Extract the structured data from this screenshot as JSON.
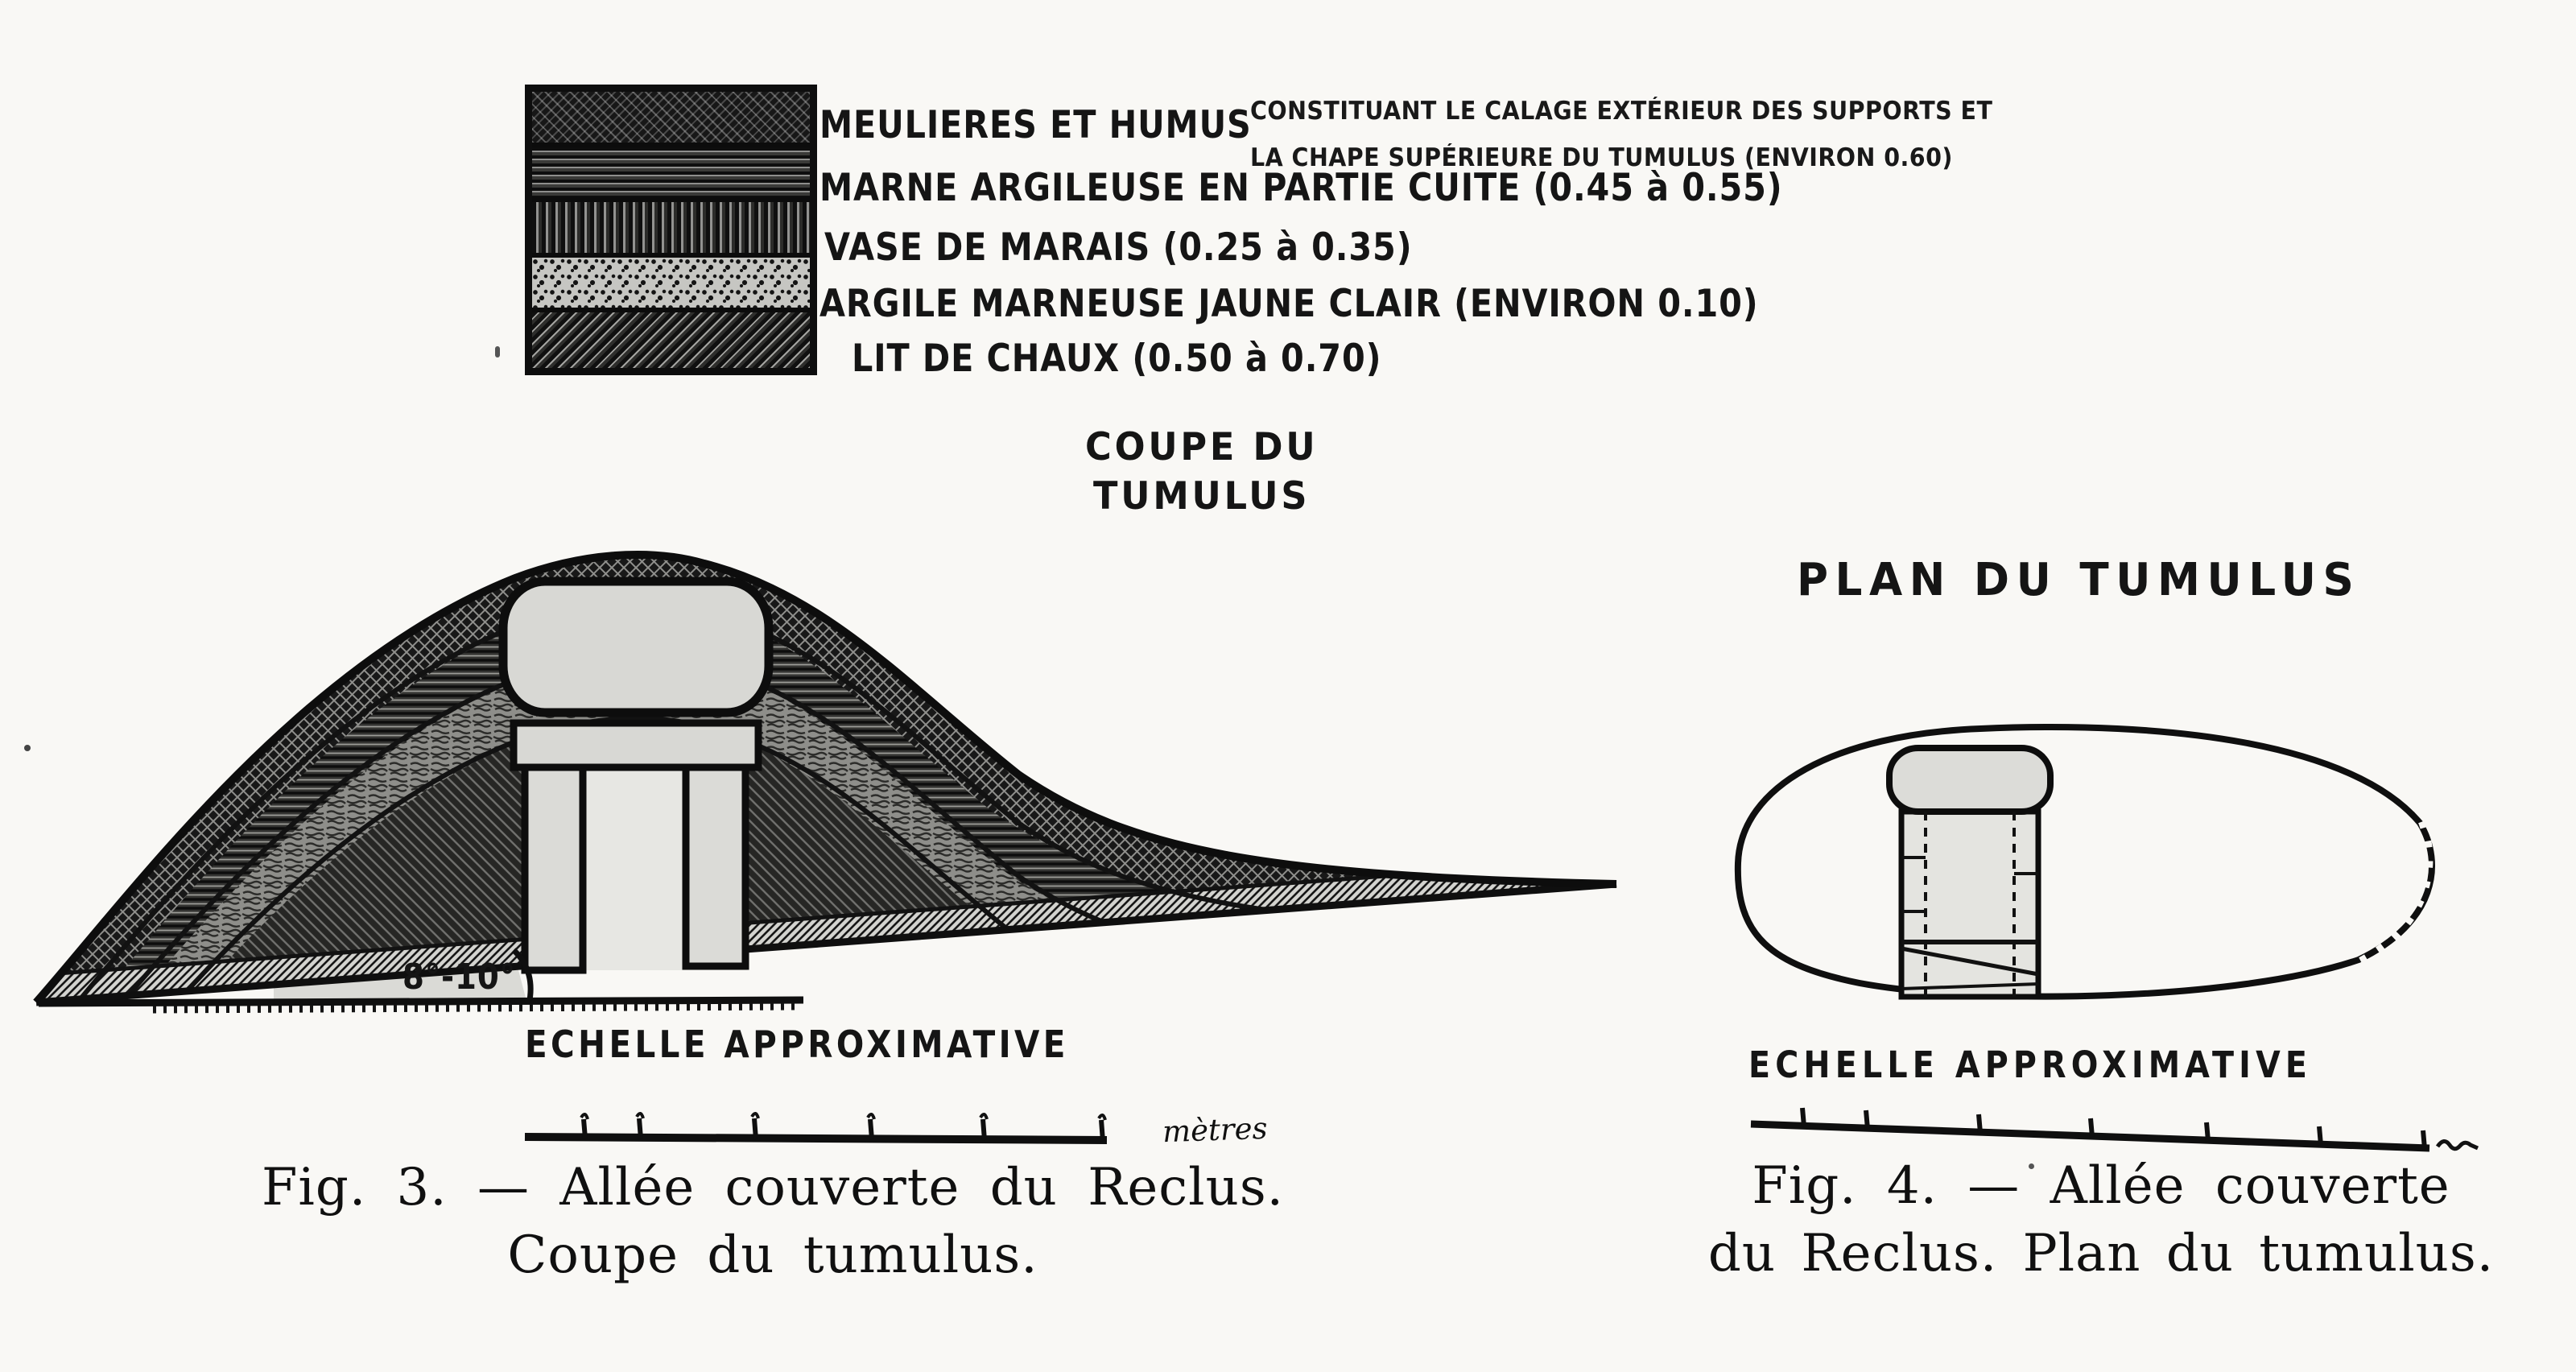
{
  "document": {
    "background_color": "#f9f8f5",
    "ink_color": "#131313"
  },
  "legend": {
    "entries": [
      {
        "pattern": "crosshatch-dark",
        "label": "MEULIERES ET HUMUS"
      },
      {
        "pattern": "horizontal-lines",
        "label": "MARNE ARGILEUSE EN PARTIE CUITE (0.45 à 0.55)"
      },
      {
        "pattern": "vertical-lines",
        "label": "VASE DE MARAIS (0.25 à 0.35)"
      },
      {
        "pattern": "speckle",
        "label": "ARGILE MARNEUSE JAUNE CLAIR (ENVIRON 0.10)"
      },
      {
        "pattern": "diagonal-lines",
        "label": "LIT DE CHAUX (0.50 à 0.70)"
      }
    ],
    "annotation": {
      "line1": "CONSTITUANT LE CALAGE EXTÉRIEUR DES SUPPORTS ET",
      "line2": "LA CHAPE SUPÉRIEURE DU TUMULUS (ENVIRON 0.60)"
    }
  },
  "section_figure": {
    "title_line1": "COUPE DU",
    "title_line2": "TUMULUS",
    "angle_label": "8°-10°",
    "scale_title": "ECHELLE APPROXIMATIVE",
    "scale_unit": "mètres"
  },
  "plan_figure": {
    "title": "PLAN DU TUMULUS",
    "scale_title": "ECHELLE APPROXIMATIVE"
  },
  "captions": {
    "fig3": {
      "line1": "Fig. 3. — Allée couverte du Reclus.",
      "line2": "Coupe du tumulus."
    },
    "fig4": {
      "line1": "Fig. 4. — Allée couverte",
      "line2": "du Reclus. Plan du tumulus."
    }
  }
}
